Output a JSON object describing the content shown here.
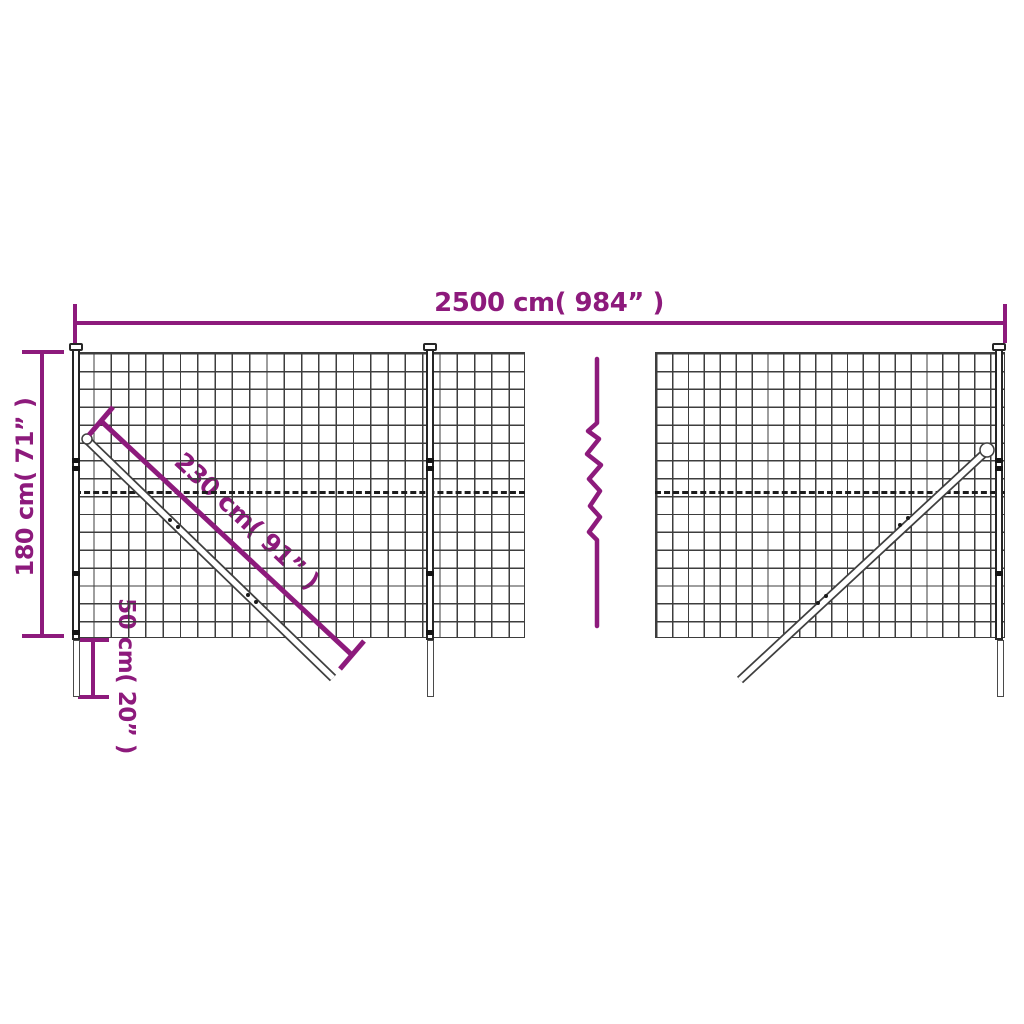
{
  "diagram": {
    "type": "wire-mesh-fence-dimension-diagram",
    "dimensions": {
      "width_label": "2500 cm( 984” )",
      "height_label": "180 cm( 71” )",
      "brace_label": "230 cm( 91” )",
      "spike_label": "50 cm( 20” )"
    },
    "colors": {
      "dimension": "#8d1a7c",
      "mesh": "#3d3d3d",
      "post_outline": "#262626",
      "background": "#ffffff"
    }
  }
}
